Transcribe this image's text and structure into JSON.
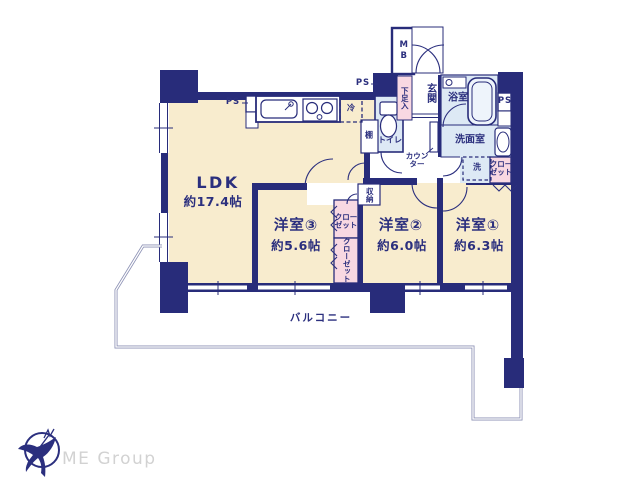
{
  "labels": {
    "ldk": "LDK",
    "ldk_size": "約17.4帖",
    "room3": "洋室③",
    "room3_size": "約5.6帖",
    "room2": "洋室②",
    "room2_size": "約6.0帖",
    "room1": "洋室①",
    "room1_size": "約6.3帖",
    "balcony": "バルコニー",
    "entrance": "玄関",
    "bath": "浴室",
    "washroom": "洗面室",
    "toilet": "トイレ",
    "mb": "MB",
    "ps": "PS",
    "shoe_box": "下足入",
    "fridge": "冷",
    "shelf": "棚",
    "storage": "収納",
    "washer": "洗",
    "counter_l1": "カウン",
    "counter_l2": "ター",
    "closet_l1": "クロー",
    "closet_l2": "ゼット",
    "closet_v": "クローゼット"
  },
  "branding": {
    "company": "ME Group"
  },
  "colors": {
    "wall": "#282c7a",
    "text": "#2b2f7e",
    "floor": "#f8ecce",
    "wet_area": "#dde9f5",
    "closet": "#f8d8e2",
    "balcony_line": "#8d92b5",
    "logo_text": "#d2d2d2"
  }
}
